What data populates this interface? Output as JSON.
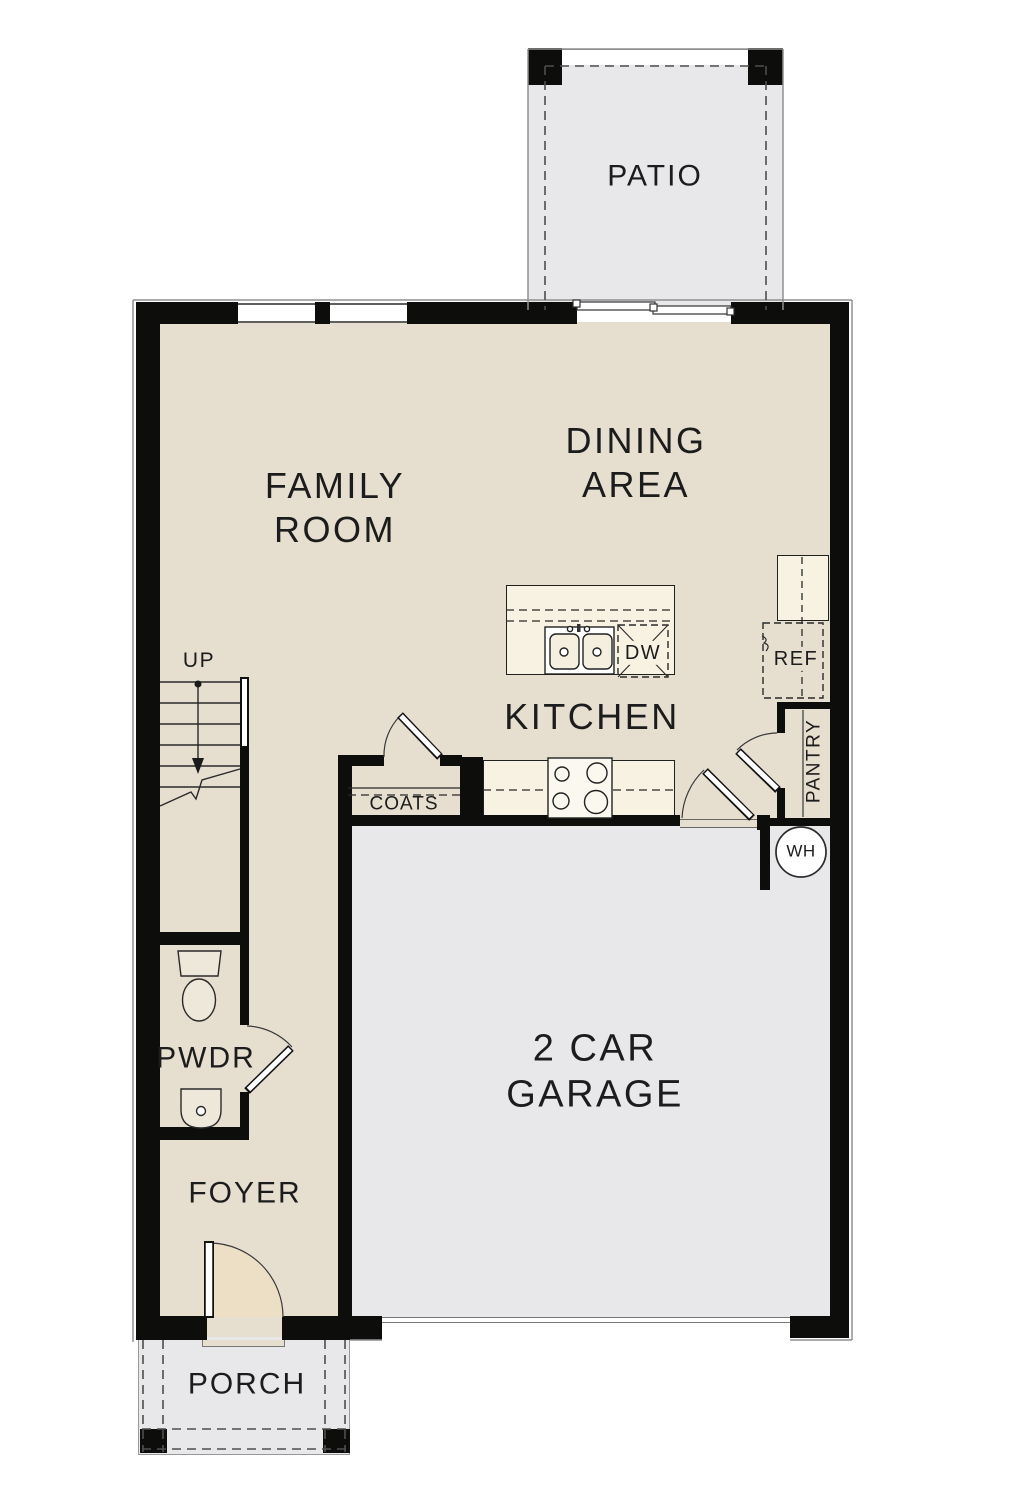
{
  "title": "First floor plan",
  "colors": {
    "floor_beige": "#e6decf",
    "exterior_gray": "#e8e8ea",
    "counter_cream": "#f8f2e2",
    "wall_black": "#0d0d0c",
    "door_swing_cream": "#eddfc6"
  },
  "labels": {
    "patio": "PATIO",
    "family_room": [
      "FAMILY",
      "ROOM"
    ],
    "dining_area": [
      "DINING",
      "AREA"
    ],
    "kitchen": "KITCHEN",
    "garage": [
      "2 CAR",
      "GARAGE"
    ],
    "up": "UP",
    "coats": "COATS",
    "dw": "DW",
    "ref": "REF",
    "pantry": "PANTRY",
    "wh": "WH",
    "pwdr": "PWDR",
    "foyer": "FOYER",
    "porch": "PORCH"
  }
}
